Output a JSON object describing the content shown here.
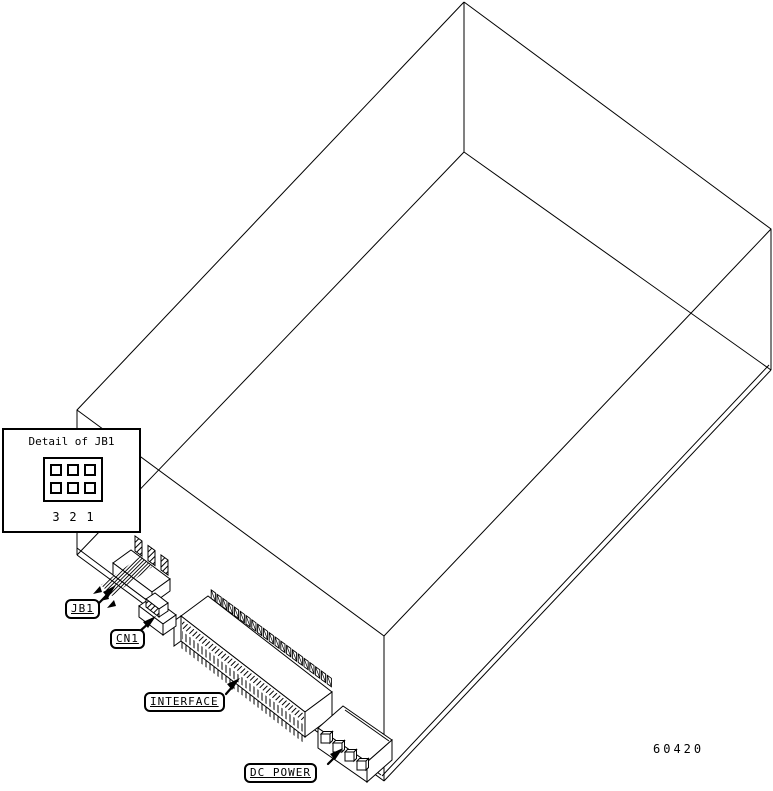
{
  "figure": {
    "part_number": "60420",
    "detail_inset": {
      "title": "Detail of JB1",
      "pin_numbers": [
        "3",
        "2",
        "1"
      ]
    },
    "callouts": {
      "jb1": "JB1",
      "cn1": "CN1",
      "interface": "INTERFACE",
      "dc_power": "DC POWER"
    },
    "colors": {
      "line": "#000000",
      "background": "#ffffff"
    }
  }
}
